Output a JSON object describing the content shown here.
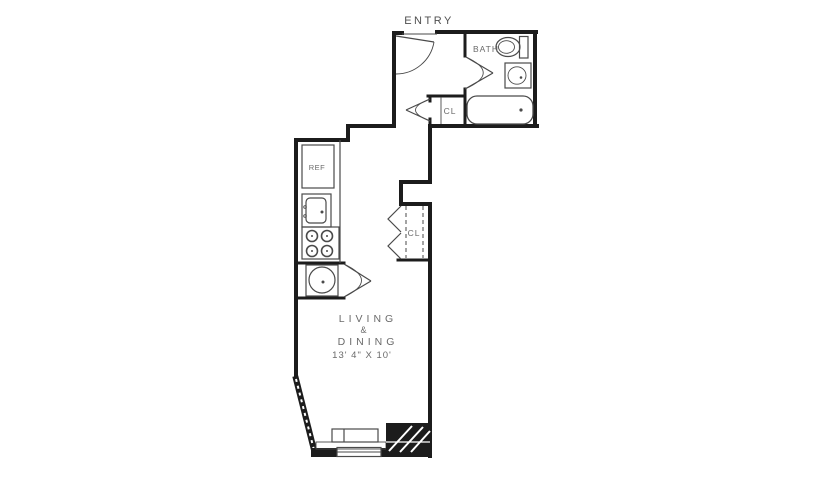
{
  "floorplan": {
    "labels": {
      "entry": "ENTRY",
      "bath": "BATH",
      "closet_upper": "CL",
      "closet_lower": "CL",
      "refrigerator": "REF",
      "living_line1": "LIVING",
      "living_amp": "&",
      "living_line2": "DINING",
      "living_dims": "13' 4\" X 10'"
    },
    "colors": {
      "background": "#ffffff",
      "wall": "#1c1c1c",
      "fixture": "#4a4a4a",
      "text": "#6a6a6a",
      "text_dark": "#4f4f4f"
    }
  }
}
